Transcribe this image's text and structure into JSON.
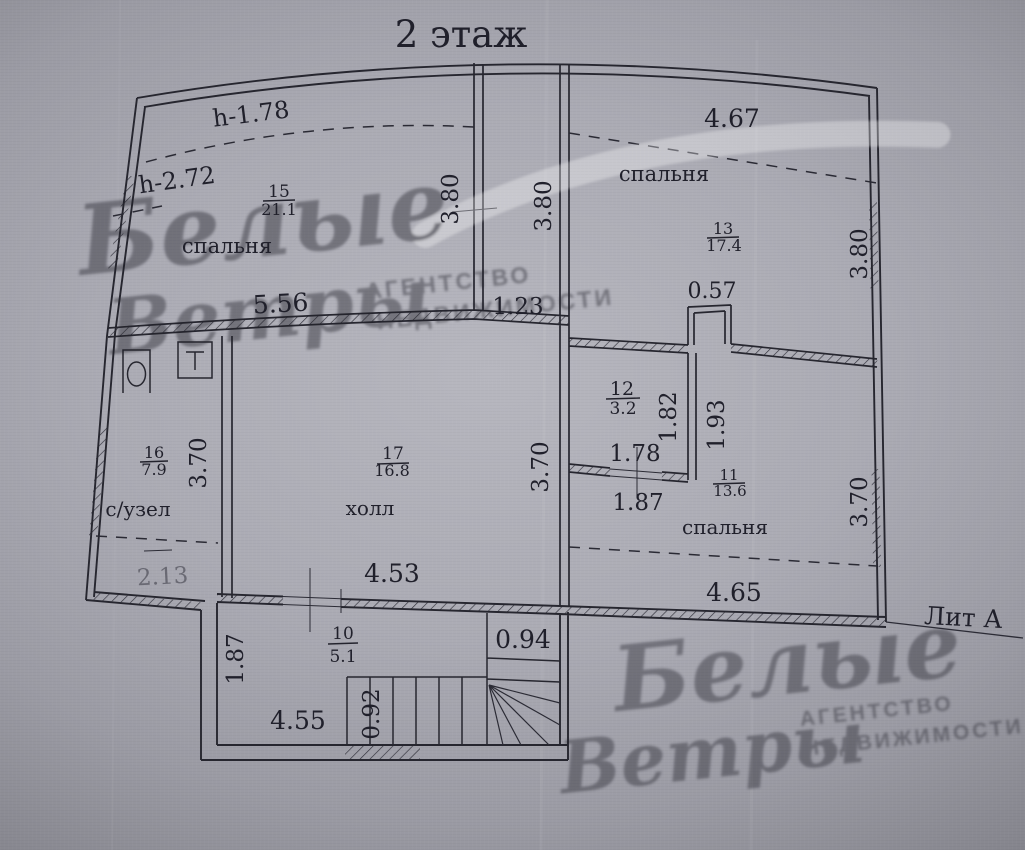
{
  "title": "2 этаж",
  "lit_label": "Лит  А",
  "heights": {
    "h1": "h-1.78",
    "h2": "h-2.72"
  },
  "rooms": {
    "r15": {
      "num": "15",
      "area": "21.1",
      "label": "спальня"
    },
    "r13": {
      "num": "13",
      "area": "17.4",
      "label": "спальня"
    },
    "r12": {
      "num": "12",
      "area": "3.2"
    },
    "r11": {
      "num": "11",
      "area": "13.6",
      "label": "спальня"
    },
    "r16": {
      "num": "16",
      "area": "7.9",
      "label": "с/узел"
    },
    "r17": {
      "num": "17",
      "area": "16.8",
      "label": "холл"
    },
    "r10": {
      "num": "10",
      "area": "5.1"
    }
  },
  "dims": {
    "room15_width": "5.56",
    "strip_height_left": "3.80",
    "strip_height_right": "3.80",
    "strip_width": "1.23",
    "room13_width": "4.67",
    "room13_height": "3.80",
    "notch_width": "0.57",
    "room12_height": "1.82",
    "room11_nook_height": "1.93",
    "room12_door_width": "1.78",
    "room12_below": "1.87",
    "room11_height": "3.70",
    "room11_width": "4.65",
    "bath_height": "3.70",
    "bath_width": "2.13",
    "hall_height": "3.70",
    "hall_width": "4.53",
    "stair_room_height": "1.87",
    "stair_room_width": "4.55",
    "stair_width": "0.92",
    "closet_width": "0.94"
  },
  "watermark": {
    "word1": "Белые",
    "word2": "Ветры",
    "agency1": "АГЕНТСТВО",
    "agency2": "НЕДВИЖИМОСТИ"
  }
}
